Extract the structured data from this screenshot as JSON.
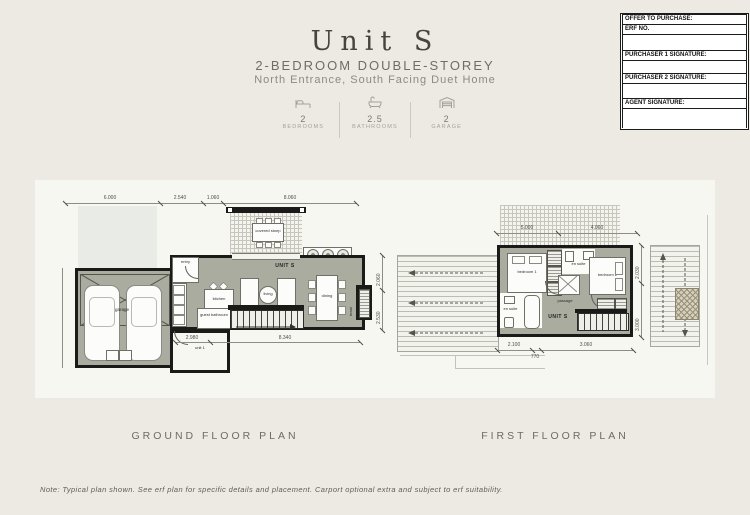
{
  "page": {
    "title": "Unit S",
    "subtitle": "2-BEDROOM DOUBLE-STOREY",
    "tagline": "North Entrance, South Facing Duet Home",
    "note": "Note: Typical plan shown. See erf plan for specific details and placement. Carport optional extra and subject to erf suitability."
  },
  "offer_box": {
    "header": "OFFER TO PURCHASE:",
    "erf_label": "ERF NO.",
    "purchaser1_label": "PURCHASER 1 SIGNATURE:",
    "purchaser2_label": "PURCHASER 2 SIGNATURE:",
    "agent_label": "AGENT SIGNATURE:"
  },
  "stats": [
    {
      "icon": "bed-icon",
      "value": "2",
      "label": "BEDROOMS"
    },
    {
      "icon": "bath-icon",
      "value": "2.5",
      "label": "BATHROOMS"
    },
    {
      "icon": "garage-icon",
      "value": "2",
      "label": "GARAGE"
    }
  ],
  "ground_floor": {
    "caption": "GROUND FLOOR PLAN",
    "unit_label": "UNIT S",
    "rooms": {
      "garage": "garage",
      "entry": "entry",
      "kitchen": "kitchen",
      "living": "living",
      "dining": "dining",
      "stoep": "covered stoep",
      "guest_bathroom": "guest bathroom",
      "unit1": "unit 1",
      "braai": "braai"
    },
    "dims_top": [
      "6.000",
      "2.540",
      "1.060",
      "8.060"
    ],
    "dims_bottom": [
      "2.980",
      "8.340"
    ],
    "dims_right": [
      "2.060",
      "2.530"
    ]
  },
  "first_floor": {
    "caption": "FIRST FLOOR PLAN",
    "unit_label": "UNIT S",
    "rooms": {
      "bedroom1": "bedroom 1",
      "ensuite1": "en suite",
      "bedroom2": "bedroom 2",
      "ensuite2": "en suite",
      "passage": "passage"
    },
    "dims_top": [
      "5.000",
      "4.060"
    ],
    "dims_bottom": [
      "2.100",
      "770",
      "3.060"
    ],
    "dims_right": [
      "2.030",
      "3.000"
    ]
  },
  "colors": {
    "page_bg": "#eceae2",
    "panel": "#f7f7f2",
    "floor_fill": "#a9ac9f",
    "wall": "#1a1a18"
  }
}
